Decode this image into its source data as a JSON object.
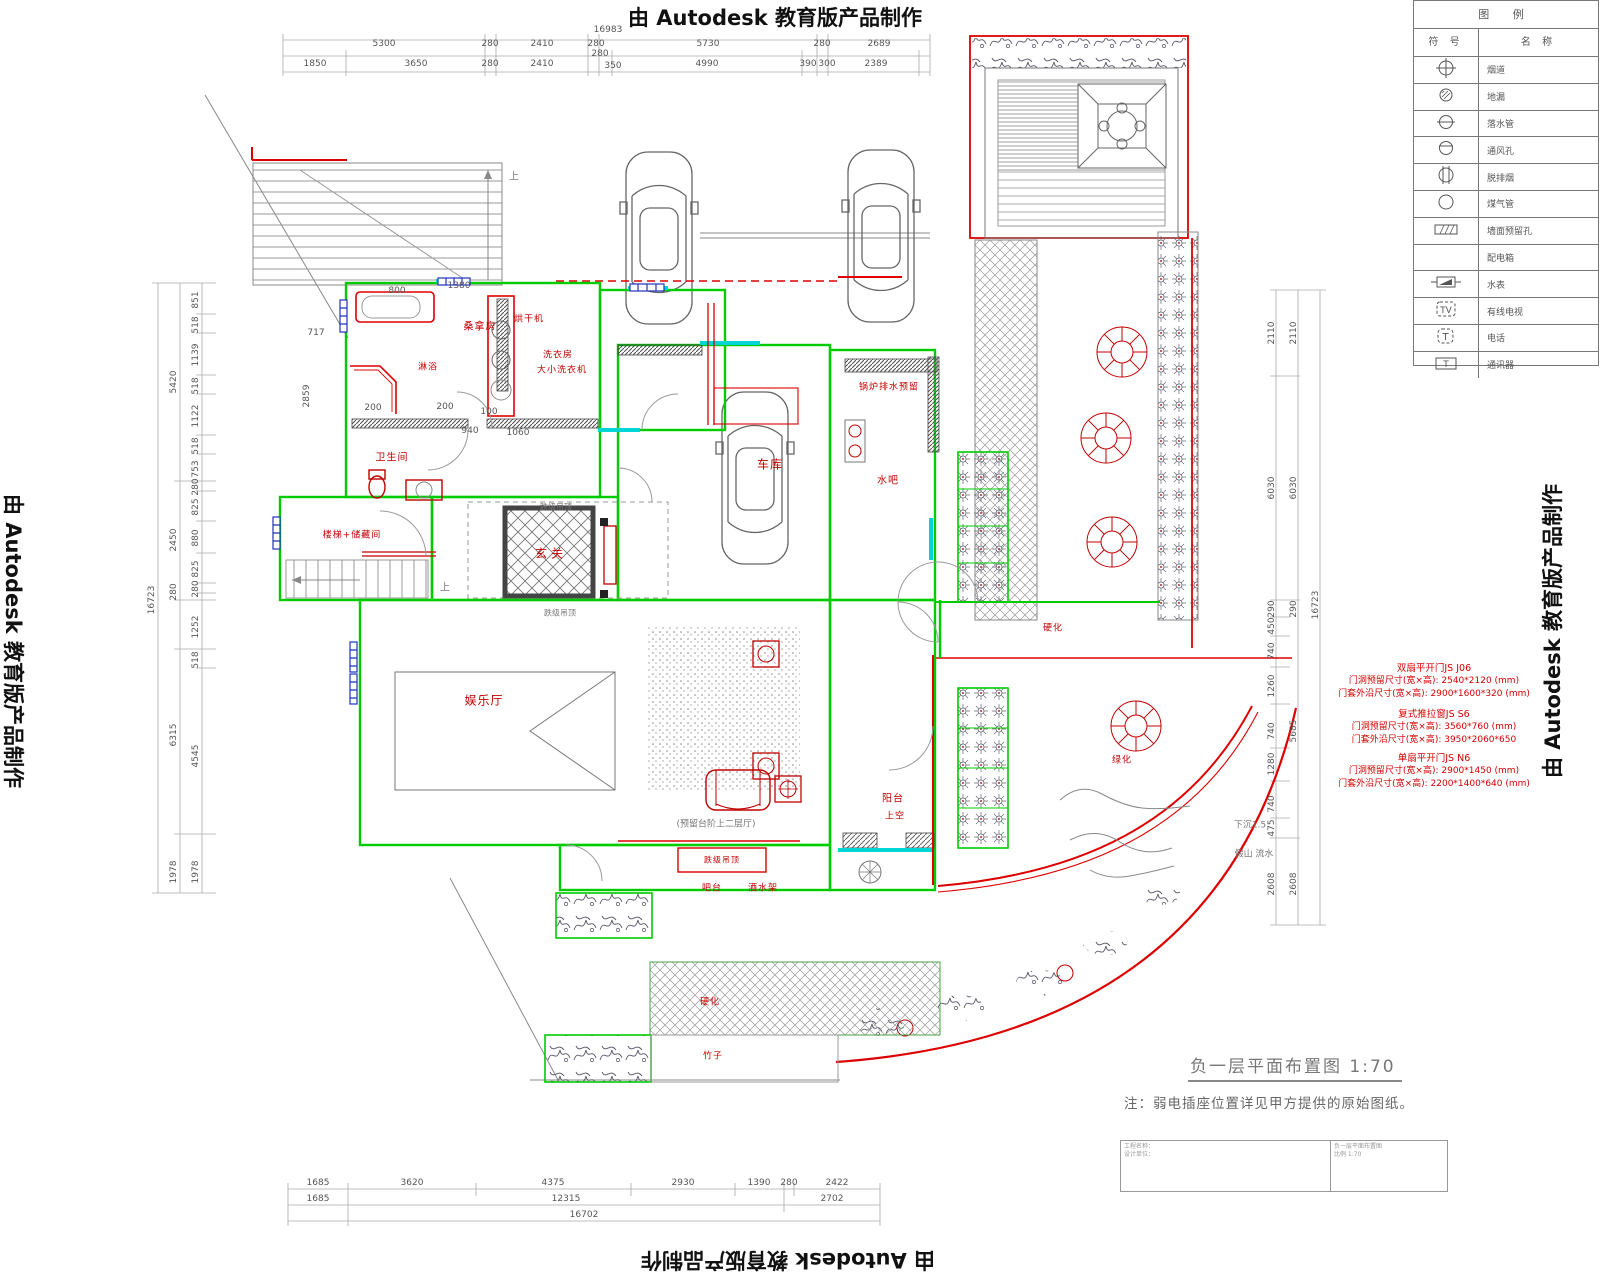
{
  "watermark": {
    "text": "由 Autodesk 教育版产品制作"
  },
  "legend": {
    "title": "图  例",
    "col_symbol": "符 号",
    "col_name": "名 称",
    "rows": [
      {
        "icon": "flue-icon",
        "name": "烟道"
      },
      {
        "icon": "floor-drain-icon",
        "name": "地漏"
      },
      {
        "icon": "downpipe-icon",
        "name": "落水管"
      },
      {
        "icon": "vent-hole-icon",
        "name": "通风孔"
      },
      {
        "icon": "exhaust-icon",
        "name": "脱排烟"
      },
      {
        "icon": "gas-pipe-icon",
        "name": "煤气管"
      },
      {
        "icon": "wall-hole-icon",
        "name": "墙面预留孔"
      },
      {
        "icon": "power-box-icon",
        "name": "配电箱"
      },
      {
        "icon": "water-meter-icon",
        "name": "水表"
      },
      {
        "icon": "catv-icon",
        "name": "有线电视"
      },
      {
        "icon": "phone-icon",
        "name": "电话"
      },
      {
        "icon": "intercom-icon",
        "name": "通讯器"
      }
    ]
  },
  "labels": {
    "sauna": "桑拿房",
    "dryer": "烘干机",
    "laundry": "洗衣房",
    "washers": "大小洗衣机",
    "shower": "淋浴",
    "bathroom": "卫生间",
    "stairs_storage": "楼梯+储藏间",
    "foyer": "玄关",
    "garage": "车库",
    "boiler": "锅炉排水预留",
    "water_bar": "水吧",
    "rec_room": "娱乐厅",
    "balcony": "阳台",
    "balcony_void": "上空",
    "dropped_ceiling": "跌级吊顶",
    "bar": "吧台",
    "wine_rack": "酒水架",
    "hard1": "硬化",
    "green1": "绿化",
    "hard2": "硬化",
    "bamboo": "竹子",
    "up": "上",
    "ceil_top": "跌级吊顶",
    "ceil_bot": "跌级吊顶",
    "mezzanine": "(预留台阶上二层厅)",
    "sunken": "下沉1.5",
    "rockery": "假山 流水"
  },
  "specs": {
    "blocks": [
      {
        "title": "双扇平开门JS J06",
        "line1": "门洞预留尺寸(宽×高): 2540*2120 (mm)",
        "line2": "门套外沿尺寸(宽×高): 2900*1600*320 (mm)"
      },
      {
        "title": "复式推拉窗JS S6",
        "line1": "门洞预留尺寸(宽×高): 3560*760 (mm)",
        "line2": "门套外沿尺寸(宽×高): 3950*2060*650"
      },
      {
        "title": "单扇平开门JS N6",
        "line1": "门洞预留尺寸(宽×高): 2900*1450 (mm)",
        "line2": "门套外沿尺寸(宽×高): 2200*1400*640 (mm)"
      }
    ]
  },
  "dims": {
    "top": {
      "overall": "16983",
      "row1": [
        "5300",
        "280",
        "2410",
        "280",
        "5730",
        "280",
        "2689"
      ],
      "row2": [
        "1850",
        "3650",
        "280",
        "2410",
        "280",
        "350",
        "4990",
        "390",
        "300",
        "2389"
      ]
    },
    "bottom": {
      "row1": [
        "1685",
        "3620",
        "4375",
        "2930",
        "1390",
        "280",
        "2422"
      ],
      "row2": [
        "1685",
        "12315",
        "2702"
      ],
      "row3": [
        "16702"
      ]
    },
    "left": {
      "outer": "16723",
      "mid": [
        "5420",
        "2450",
        "280",
        "6315",
        "1978"
      ],
      "inner": [
        "851",
        "518",
        "1139",
        "518",
        "1122",
        "518",
        "753",
        "280",
        "825",
        "880",
        "825",
        "280",
        "1252",
        "518",
        "4545",
        "1978"
      ]
    },
    "right": {
      "outer": "16723",
      "mid": [
        "2110",
        "6030",
        "290",
        "5685",
        "2608"
      ],
      "inner": [
        "2110",
        "6030",
        "290",
        "450",
        "740",
        "1260",
        "740",
        "1280",
        "740",
        "475",
        "2608"
      ]
    },
    "inner": [
      "717",
      "2859",
      "800",
      "1380",
      "200",
      "200",
      "100",
      "940",
      "1060"
    ]
  },
  "drawing_title": {
    "text": "负一层平面布置图",
    "scale": "1:70"
  },
  "note": {
    "text": "注：弱电插座位置详见甲方提供的原始图纸。"
  },
  "title_block": {
    "left_line1": "工程名称：",
    "left_line2": "设计单位：",
    "right_line1": "负一层平面布置图",
    "right_line2": "比例 1:70"
  }
}
